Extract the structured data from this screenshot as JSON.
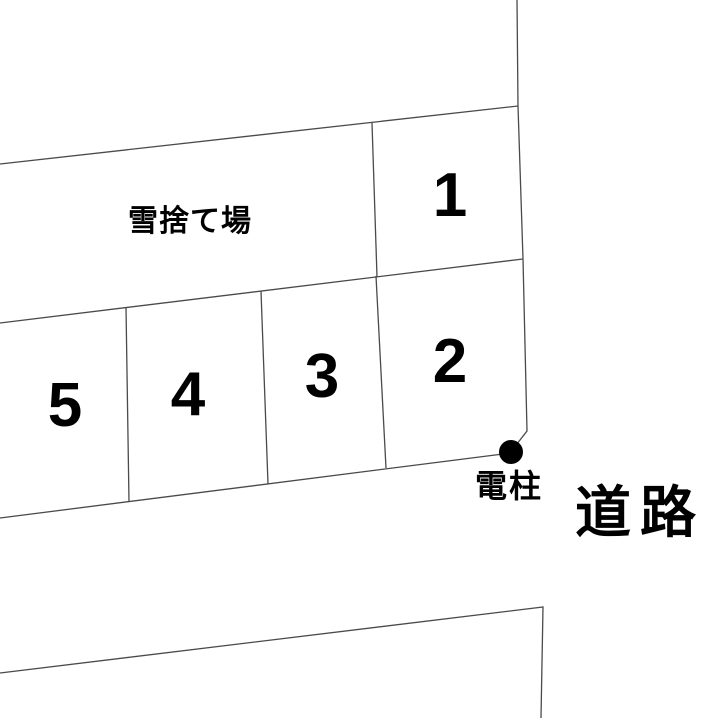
{
  "diagram": {
    "title": "parking-lot-site-plan",
    "snow_area": {
      "label": "雪捨て場"
    },
    "parking_spaces": [
      {
        "id": 1,
        "label": "1"
      },
      {
        "id": 2,
        "label": "2"
      },
      {
        "id": 3,
        "label": "3"
      },
      {
        "id": 4,
        "label": "4"
      },
      {
        "id": 5,
        "label": "5"
      }
    ],
    "utility_pole": {
      "label": "電柱"
    },
    "road": {
      "label": "道路"
    },
    "colors": {
      "line": "#4a4a4a",
      "ink": "#000000",
      "background": "#ffffff"
    }
  }
}
